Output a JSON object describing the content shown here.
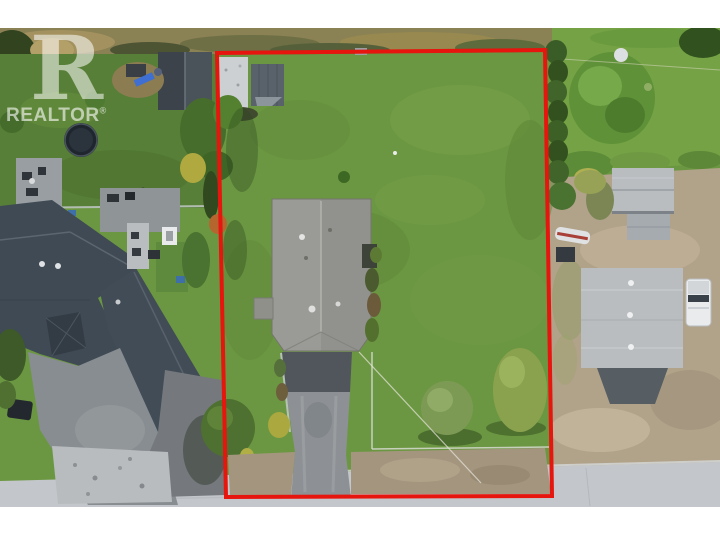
{
  "watermark": {
    "logo_letter": "R",
    "brand": "REALTOR",
    "registered": "®"
  },
  "colors": {
    "boundary": "#e6150d",
    "lawn_subject": "#6c9742",
    "lawn_neighbor_left": "#577f37",
    "lawn_neighbor_right": "#74a245",
    "scrub": "#8a8154",
    "dirt": "#b1a28a",
    "dirt_shoulder": "#a4967e",
    "road": "#c3c7cb",
    "asphalt_courtyard": "#888d91",
    "driveway_upper": "#50565c",
    "driveway_lower": "#8d9195",
    "subject_roof": "#9a9a96",
    "neighbor_roof": "#3f4a54",
    "metal_roof": "#b9bdc0",
    "shed_white_roof": "#ccd0d3",
    "shed_gray_roof": "#59616a",
    "hedge_green": "#3a5c26",
    "truck_white": "#e9ebec"
  }
}
